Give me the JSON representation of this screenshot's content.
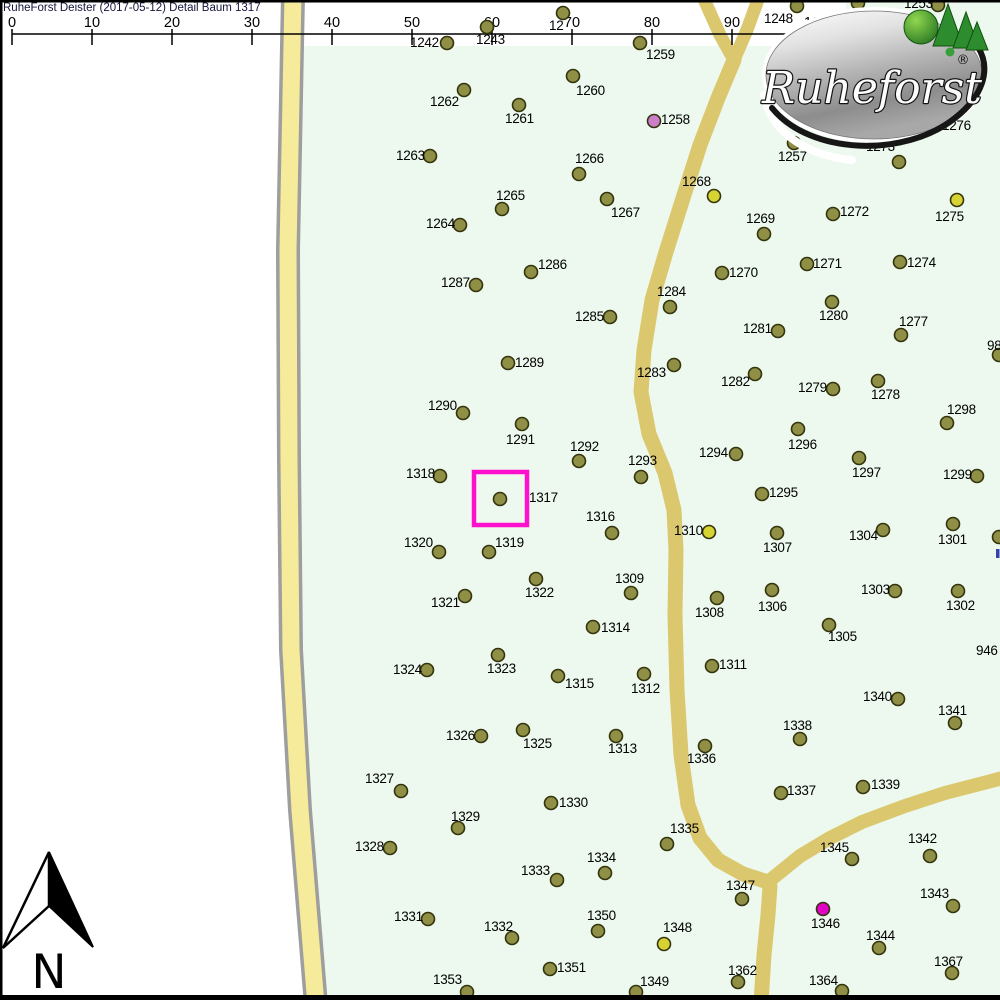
{
  "title": "RuheForst Deister (2017-05-12) Detail  Baum 1317",
  "north_label": "N",
  "logo": {
    "text": "Ruheforst",
    "reg": "®"
  },
  "highlight": {
    "target_tree": "1317",
    "x": 474,
    "y": 472,
    "size": 53,
    "color": "#ff10cc"
  },
  "scalebar": {
    "line_y": 34,
    "x_start": 12,
    "x_end": 813,
    "ticks": [
      {
        "label": "0",
        "x": 12
      },
      {
        "label": "10",
        "x": 92
      },
      {
        "label": "20",
        "x": 172
      },
      {
        "label": "30",
        "x": 252
      },
      {
        "label": "40",
        "x": 332
      },
      {
        "label": "50",
        "x": 412
      },
      {
        "label": "60",
        "x": 492
      },
      {
        "label": "70",
        "x": 572
      },
      {
        "label": "80",
        "x": 652
      },
      {
        "label": "90",
        "x": 732
      },
      {
        "label": "100m",
        "x": 813,
        "lx": 822
      }
    ]
  },
  "colors": {
    "map_bg": "#edf9ee",
    "unmapped_white": "#ffffff",
    "left_road_fill": "#f6eb9a",
    "left_road_casing": "#9e9e9e",
    "mid_road_fill": "#dbc86e",
    "olive": "#8f8f45",
    "yellow": "#d6d433",
    "pink": "#cb7fc7",
    "magenta": "#e203c7",
    "dot_stroke": "#33330e",
    "highlight": "#ff10cc",
    "blue_mark": "#3344aa"
  },
  "trees": [
    {
      "id": "1242",
      "x": 447,
      "y": 43,
      "lx": 410,
      "ly": 36
    },
    {
      "id": "1243",
      "x": 487,
      "y": 27,
      "lx": 476,
      "ly": 33
    },
    {
      "id": "12",
      "x": 563,
      "y": 13,
      "lx": 549,
      "ly": 19
    },
    {
      "id": "1259",
      "x": 640,
      "y": 43,
      "lx": 646,
      "ly": 48
    },
    {
      "id": "1248",
      "x": 797,
      "y": 6,
      "lx": 764,
      "ly": 12
    },
    {
      "id": "1255",
      "x": 858,
      "y": 3,
      "lx": 841,
      "ly": 8
    },
    {
      "id": "1253",
      "x": 938,
      "y": 5,
      "lx": 904,
      "ly": -3
    },
    {
      "id": "1260",
      "x": 573,
      "y": 76,
      "lx": 576,
      "ly": 84
    },
    {
      "id": "1262",
      "x": 464,
      "y": 90,
      "lx": 430,
      "ly": 95
    },
    {
      "id": "1261",
      "x": 519,
      "y": 105,
      "lx": 505,
      "ly": 112
    },
    {
      "id": "1258",
      "x": 654,
      "y": 121,
      "lx": 661,
      "ly": 113,
      "c": "pink"
    },
    {
      "id": "1257",
      "x": 794,
      "y": 143,
      "lx": 778,
      "ly": 150
    },
    {
      "id": "1273",
      "x": 899,
      "y": 162,
      "lx": 866,
      "ly": 140
    },
    {
      "id": "1276",
      "lx": 942,
      "ly": 119
    },
    {
      "id": "1263",
      "x": 430,
      "y": 156,
      "lx": 396,
      "ly": 149
    },
    {
      "id": "1266",
      "x": 579,
      "y": 174,
      "lx": 575,
      "ly": 152
    },
    {
      "id": "1268",
      "x": 714,
      "y": 196,
      "lx": 682,
      "ly": 175,
      "c": "yellow"
    },
    {
      "id": "1265",
      "x": 502,
      "y": 209,
      "lx": 496,
      "ly": 189
    },
    {
      "id": "1267",
      "x": 607,
      "y": 199,
      "lx": 611,
      "ly": 206
    },
    {
      "id": "1269",
      "x": 764,
      "y": 234,
      "lx": 746,
      "ly": 212
    },
    {
      "id": "1272",
      "x": 833,
      "y": 214,
      "lx": 840,
      "ly": 205
    },
    {
      "id": "1275",
      "x": 957,
      "y": 200,
      "lx": 935,
      "ly": 210,
      "c": "yellow"
    },
    {
      "id": "1264",
      "x": 460,
      "y": 225,
      "lx": 426,
      "ly": 217
    },
    {
      "id": "1270",
      "x": 722,
      "y": 273,
      "lx": 729,
      "ly": 266
    },
    {
      "id": "1271",
      "x": 807,
      "y": 264,
      "lx": 813,
      "ly": 257
    },
    {
      "id": "1274",
      "x": 900,
      "y": 262,
      "lx": 907,
      "ly": 256
    },
    {
      "id": "1286",
      "x": 531,
      "y": 272,
      "lx": 538,
      "ly": 258
    },
    {
      "id": "1287",
      "x": 476,
      "y": 285,
      "lx": 441,
      "ly": 276
    },
    {
      "id": "1284",
      "x": 670,
      "y": 307,
      "lx": 657,
      "ly": 285
    },
    {
      "id": "1280",
      "x": 832,
      "y": 302,
      "lx": 819,
      "ly": 309
    },
    {
      "id": "1281",
      "x": 778,
      "y": 331,
      "lx": 743,
      "ly": 322
    },
    {
      "id": "1277",
      "x": 901,
      "y": 335,
      "lx": 899,
      "ly": 315
    },
    {
      "id": "1285",
      "x": 610,
      "y": 317,
      "lx": 575,
      "ly": 310
    },
    {
      "id": "98",
      "x": 999,
      "y": 355,
      "lx": 987,
      "ly": 339
    },
    {
      "id": "1289",
      "x": 508,
      "y": 363,
      "lx": 515,
      "ly": 356
    },
    {
      "id": "1283",
      "x": 674,
      "y": 365,
      "lx": 637,
      "ly": 366
    },
    {
      "id": "1282",
      "x": 755,
      "y": 374,
      "lx": 721,
      "ly": 375
    },
    {
      "id": "1279",
      "x": 833,
      "y": 389,
      "lx": 798,
      "ly": 381
    },
    {
      "id": "1278",
      "x": 878,
      "y": 381,
      "lx": 871,
      "ly": 388
    },
    {
      "id": "1290",
      "x": 463,
      "y": 413,
      "lx": 428,
      "ly": 399
    },
    {
      "id": "1298",
      "x": 947,
      "y": 423,
      "lx": 947,
      "ly": 403
    },
    {
      "id": "1291",
      "x": 522,
      "y": 424,
      "lx": 506,
      "ly": 433
    },
    {
      "id": "1296",
      "x": 798,
      "y": 429,
      "lx": 788,
      "ly": 438
    },
    {
      "id": "1292",
      "x": 579,
      "y": 461,
      "lx": 570,
      "ly": 440
    },
    {
      "id": "1293",
      "x": 641,
      "y": 477,
      "lx": 628,
      "ly": 454
    },
    {
      "id": "1294",
      "x": 736,
      "y": 454,
      "lx": 699,
      "ly": 446
    },
    {
      "id": "1297",
      "x": 859,
      "y": 458,
      "lx": 852,
      "ly": 466
    },
    {
      "id": "1299",
      "x": 977,
      "y": 476,
      "lx": 943,
      "ly": 468
    },
    {
      "id": "1318",
      "x": 440,
      "y": 476,
      "lx": 406,
      "ly": 467
    },
    {
      "id": "1317",
      "x": 500,
      "y": 499,
      "lx": 529,
      "ly": 491
    },
    {
      "id": "1316",
      "x": 612,
      "y": 533,
      "lx": 586,
      "ly": 510
    },
    {
      "id": "1310",
      "x": 709,
      "y": 532,
      "lx": 674,
      "ly": 524,
      "c": "yellow"
    },
    {
      "id": "1295",
      "x": 762,
      "y": 494,
      "lx": 769,
      "ly": 486
    },
    {
      "id": "1304",
      "x": 883,
      "y": 530,
      "lx": 849,
      "ly": 529
    },
    {
      "id": "1301",
      "x": 953,
      "y": 524,
      "lx": 938,
      "ly": 533
    },
    {
      "id": "1307",
      "x": 777,
      "y": 533,
      "lx": 763,
      "ly": 541
    },
    {
      "id": "",
      "x": 999,
      "y": 537
    },
    {
      "id": "1320",
      "x": 439,
      "y": 552,
      "lx": 404,
      "ly": 536
    },
    {
      "id": "1319",
      "x": 489,
      "y": 552,
      "lx": 495,
      "ly": 536
    },
    {
      "id": "1322",
      "x": 536,
      "y": 579,
      "lx": 525,
      "ly": 586
    },
    {
      "id": "1309",
      "x": 631,
      "y": 593,
      "lx": 615,
      "ly": 572
    },
    {
      "id": "1321",
      "x": 465,
      "y": 596,
      "lx": 431,
      "ly": 596
    },
    {
      "id": "1303",
      "x": 895,
      "y": 591,
      "lx": 861,
      "ly": 583
    },
    {
      "id": "1302",
      "x": 958,
      "y": 591,
      "lx": 946,
      "ly": 599
    },
    {
      "id": "1314",
      "x": 593,
      "y": 627,
      "lx": 601,
      "ly": 621
    },
    {
      "id": "1306",
      "x": 772,
      "y": 590,
      "lx": 758,
      "ly": 600
    },
    {
      "id": "1308",
      "x": 717,
      "y": 598,
      "lx": 695,
      "ly": 606
    },
    {
      "id": "1305",
      "x": 829,
      "y": 625,
      "lx": 828,
      "ly": 630
    },
    {
      "id": "1311",
      "x": 712,
      "y": 666,
      "lx": 719,
      "ly": 658
    },
    {
      "id": "1312",
      "x": 644,
      "y": 674,
      "lx": 631,
      "ly": 682
    },
    {
      "id": "1315",
      "x": 558,
      "y": 676,
      "lx": 565,
      "ly": 677
    },
    {
      "id": "1323",
      "x": 498,
      "y": 655,
      "lx": 487,
      "ly": 662
    },
    {
      "id": "1324",
      "x": 427,
      "y": 670,
      "lx": 393,
      "ly": 663
    },
    {
      "id": "946",
      "lx": 976,
      "ly": 644
    },
    {
      "id": "1340",
      "x": 898,
      "y": 699,
      "lx": 863,
      "ly": 690
    },
    {
      "id": "1341",
      "x": 955,
      "y": 723,
      "lx": 938,
      "ly": 704
    },
    {
      "id": "1326",
      "x": 481,
      "y": 736,
      "lx": 446,
      "ly": 729
    },
    {
      "id": "1325",
      "x": 523,
      "y": 730,
      "lx": 523,
      "ly": 737
    },
    {
      "id": "1313",
      "x": 616,
      "y": 736,
      "lx": 608,
      "ly": 742
    },
    {
      "id": "1338",
      "x": 800,
      "y": 739,
      "lx": 783,
      "ly": 719
    },
    {
      "id": "1336",
      "x": 705,
      "y": 746,
      "lx": 687,
      "ly": 752
    },
    {
      "id": "1327",
      "x": 401,
      "y": 791,
      "lx": 365,
      "ly": 772
    },
    {
      "id": "1337",
      "x": 781,
      "y": 793,
      "lx": 787,
      "ly": 784
    },
    {
      "id": "1339",
      "x": 863,
      "y": 787,
      "lx": 871,
      "ly": 778
    },
    {
      "id": "1330",
      "x": 551,
      "y": 803,
      "lx": 559,
      "ly": 796
    },
    {
      "id": "1329",
      "x": 458,
      "y": 828,
      "lx": 451,
      "ly": 810
    },
    {
      "id": "1335",
      "x": 667,
      "y": 844,
      "lx": 670,
      "ly": 822
    },
    {
      "id": "1334",
      "x": 605,
      "y": 873,
      "lx": 587,
      "ly": 851
    },
    {
      "id": "1345",
      "x": 852,
      "y": 859,
      "lx": 820,
      "ly": 841
    },
    {
      "id": "1328",
      "x": 390,
      "y": 848,
      "lx": 355,
      "ly": 840
    },
    {
      "id": "1333",
      "x": 557,
      "y": 880,
      "lx": 521,
      "ly": 864
    },
    {
      "id": "1342",
      "x": 930,
      "y": 856,
      "lx": 908,
      "ly": 832
    },
    {
      "id": "1347",
      "x": 742,
      "y": 899,
      "lx": 726,
      "ly": 879
    },
    {
      "id": "1346",
      "x": 823,
      "y": 909,
      "lx": 811,
      "ly": 917,
      "c": "magenta"
    },
    {
      "id": "1331",
      "x": 428,
      "y": 919,
      "lx": 394,
      "ly": 910
    },
    {
      "id": "1332",
      "x": 512,
      "y": 938,
      "lx": 484,
      "ly": 920
    },
    {
      "id": "1350",
      "x": 598,
      "y": 931,
      "lx": 587,
      "ly": 909
    },
    {
      "id": "1348",
      "x": 664,
      "y": 944,
      "lx": 663,
      "ly": 921,
      "c": "yellow"
    },
    {
      "id": "1343",
      "x": 953,
      "y": 906,
      "lx": 920,
      "ly": 887
    },
    {
      "id": "1344",
      "x": 879,
      "y": 948,
      "lx": 866,
      "ly": 929
    },
    {
      "id": "1367",
      "x": 952,
      "y": 973,
      "lx": 934,
      "ly": 955
    },
    {
      "id": "1351",
      "x": 550,
      "y": 969,
      "lx": 557,
      "ly": 961
    },
    {
      "id": "1362",
      "x": 738,
      "y": 982,
      "lx": 728,
      "ly": 964
    },
    {
      "id": "1364",
      "x": 842,
      "y": 991,
      "lx": 809,
      "ly": 974
    },
    {
      "id": "1349",
      "x": 636,
      "y": 992,
      "lx": 640,
      "ly": 975
    },
    {
      "id": "1353",
      "x": 467,
      "y": 992,
      "lx": 433,
      "ly": 973
    }
  ]
}
